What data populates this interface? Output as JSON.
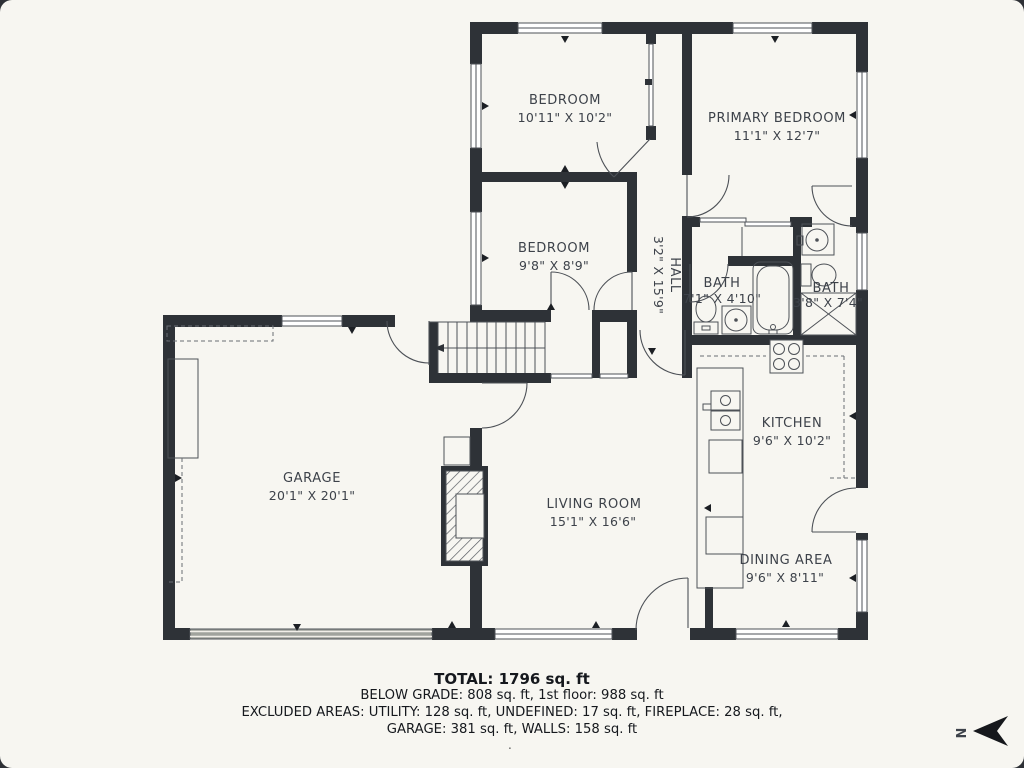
{
  "colors": {
    "background": "#f7f6f1",
    "wall": "#2e3237",
    "thin_line": "#4d5157",
    "label": "#3d424a",
    "footer_text": "#15181d",
    "garage_door_band": "#a0a39d"
  },
  "rooms": [
    {
      "id": "bedroom-1",
      "name": "BEDROOM",
      "dims": "10'11\" X 10'2\""
    },
    {
      "id": "primary-bedroom",
      "name": "PRIMARY BEDROOM",
      "dims": "11'1\" X 12'7\""
    },
    {
      "id": "bedroom-2",
      "name": "BEDROOM",
      "dims": "9'8\" X 8'9\""
    },
    {
      "id": "hall",
      "name": "HALL",
      "dims": "3'2\" X 15'9\""
    },
    {
      "id": "bath-1",
      "name": "BATH",
      "dims": "7'1\" X 4'10\""
    },
    {
      "id": "bath-2",
      "name": "BATH",
      "dims": "3'8\" X 7'4\""
    },
    {
      "id": "garage",
      "name": "GARAGE",
      "dims": "20'1\" X 20'1\""
    },
    {
      "id": "kitchen",
      "name": "KITCHEN",
      "dims": "9'6\" X 10'2\""
    },
    {
      "id": "living-room",
      "name": "LIVING ROOM",
      "dims": "15'1\" X 16'6\""
    },
    {
      "id": "dining-area",
      "name": "DINING AREA",
      "dims": "9'6\" X 8'11\""
    }
  ],
  "summary": {
    "total": "TOTAL: 1796 sq. ft",
    "grade_line": "BELOW GRADE: 808 sq. ft, 1st floor: 988 sq. ft",
    "excluded_line": "EXCLUDED AREAS: UTILITY: 128 sq. ft, UNDEFINED: 17 sq. ft, FIREPLACE: 28 sq. ft,",
    "garage_walls_line": "GARAGE: 381 sq. ft, WALLS: 158 sq. ft",
    "footer_dot": "."
  },
  "compass": {
    "letter": "N"
  }
}
